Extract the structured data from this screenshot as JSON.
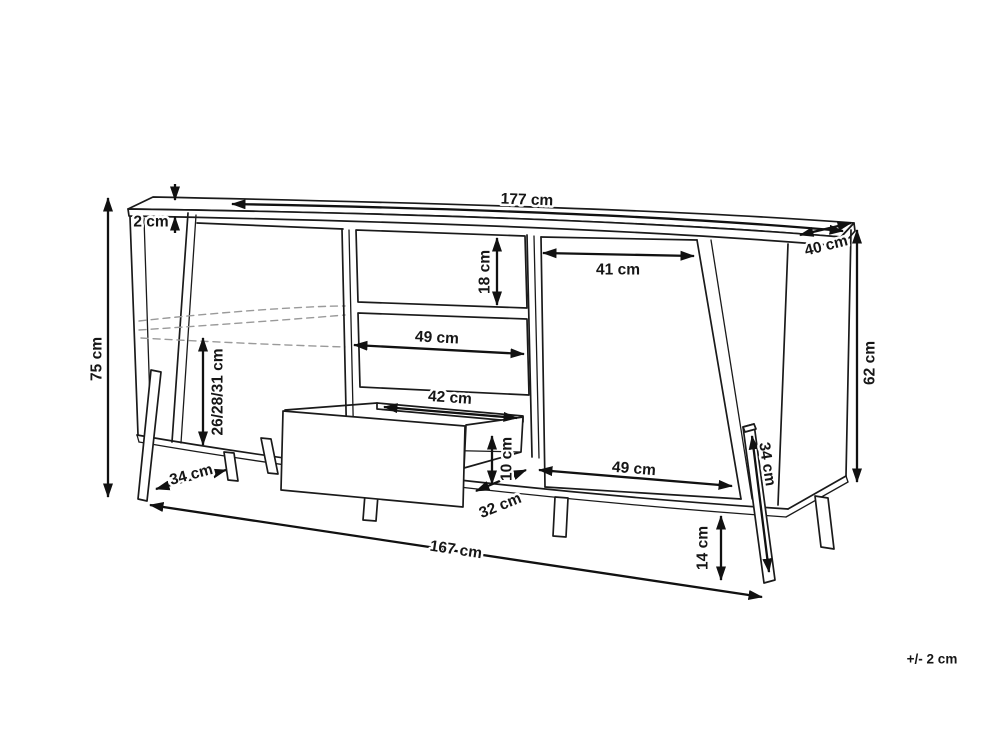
{
  "diagram": {
    "subject": "sideboard-dimension-drawing",
    "line_color": "#1a1a1a",
    "dashed_color": "#9a9a9a",
    "background": "#ffffff"
  },
  "dimensions": {
    "top_width": "177 cm",
    "top_thickness": "2 cm",
    "top_depth": "40 cm",
    "body_height": "62 cm",
    "total_height": "75 cm",
    "top_drawer_height": "18 cm",
    "right_door_width_top": "41 cm",
    "middle_drawer_width": "49 cm",
    "open_drawer_inner_width": "42 cm",
    "left_compartment_heights": "26/28/31 cm",
    "left_leg_spacing": "34 cm",
    "open_drawer_inner_height": "10 cm",
    "open_drawer_depth": "32 cm",
    "right_door_width_bottom": "49 cm",
    "base_width": "167 cm",
    "leg_height": "14 cm",
    "rear_leg_length": "34 cm"
  },
  "note": {
    "tolerance": "+/- 2 cm"
  }
}
